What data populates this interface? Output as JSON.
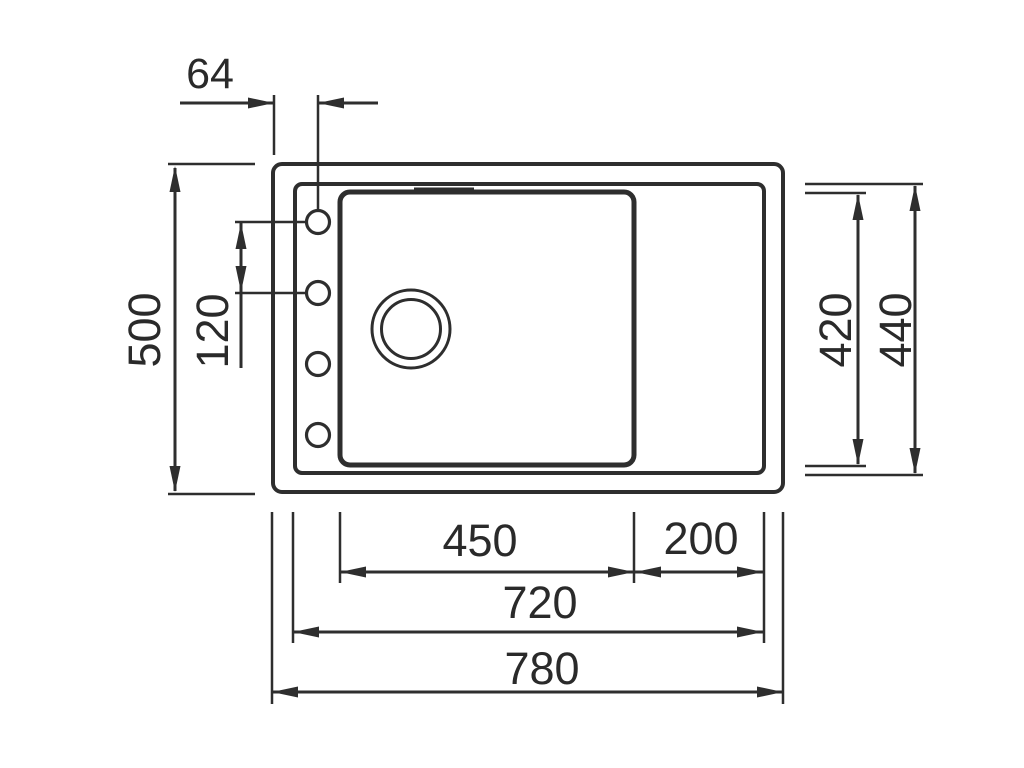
{
  "diagram": {
    "type": "technical-drawing",
    "subject": "kitchen sink with drainer, top view, dimensioned",
    "colors": {
      "background": "#ffffff",
      "line": "#2e2e2e",
      "text": "#2a2a2a"
    },
    "labels": {
      "tap_hole_offset": "64",
      "overall_depth": "500",
      "tap_hole_spacing": "120",
      "bowl_depth": "420",
      "rim_depth": "440",
      "bowl_width": "450",
      "drainer_width": "200",
      "rim_width": "720",
      "overall_width": "780"
    }
  }
}
